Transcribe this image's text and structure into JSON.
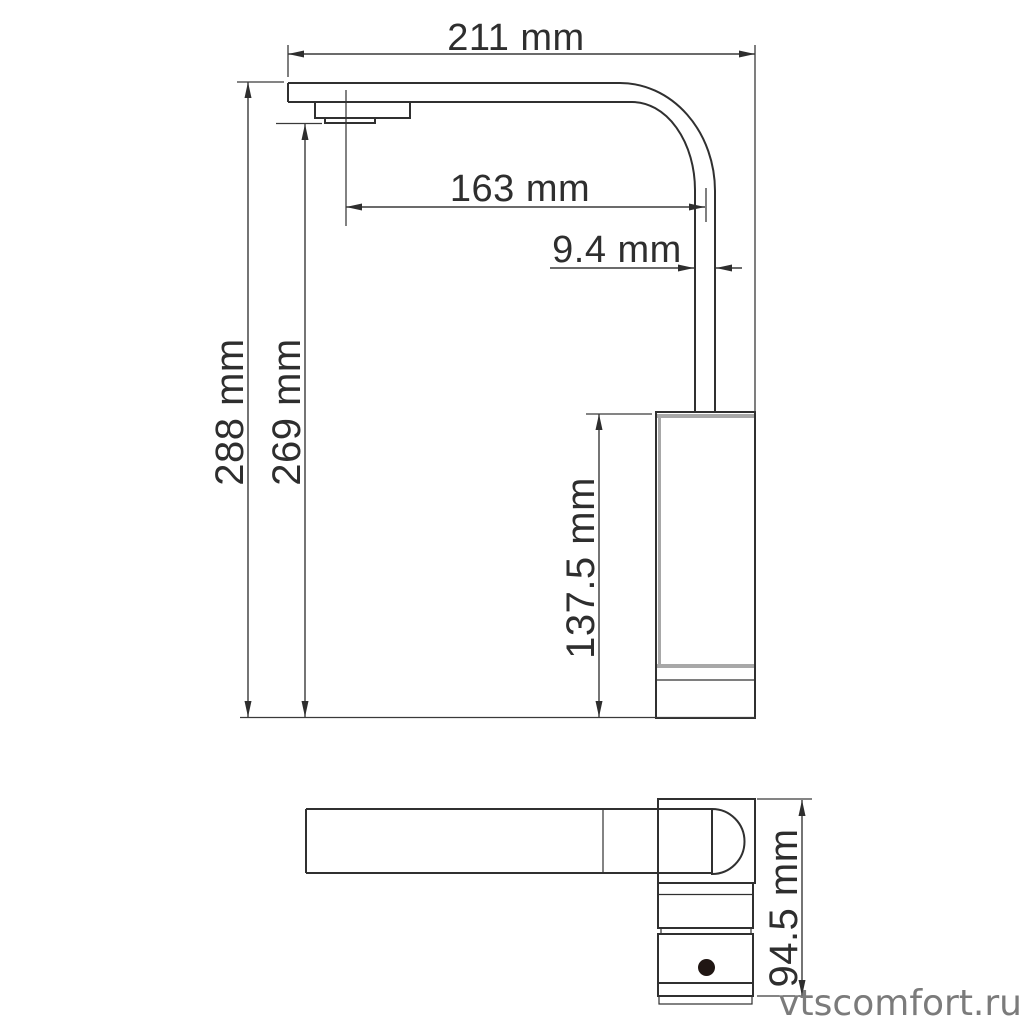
{
  "page": {
    "background": "#ffffff",
    "width": 1027,
    "height": 1027
  },
  "drawing": {
    "subject": "faucet-dimension-diagram",
    "views": [
      {
        "name": "side-view"
      },
      {
        "name": "top-view"
      }
    ],
    "dimensions": {
      "spout_span": "211 mm",
      "spout_reach": "163 mm",
      "spout_pipe_width": "9.4 mm",
      "overall_height": "288 mm",
      "spout_outlet_height": "269 mm",
      "body_height": "137.5 mm",
      "handle_length": "94.5 mm"
    },
    "watermark": "vtscomfort.ru",
    "colors": {
      "line": "#303030",
      "dimension_line": "#3a3a3a",
      "accent_gray": "#a8a8a8",
      "watermark_gray": "#7b7b7b",
      "dot": "#201613"
    }
  }
}
